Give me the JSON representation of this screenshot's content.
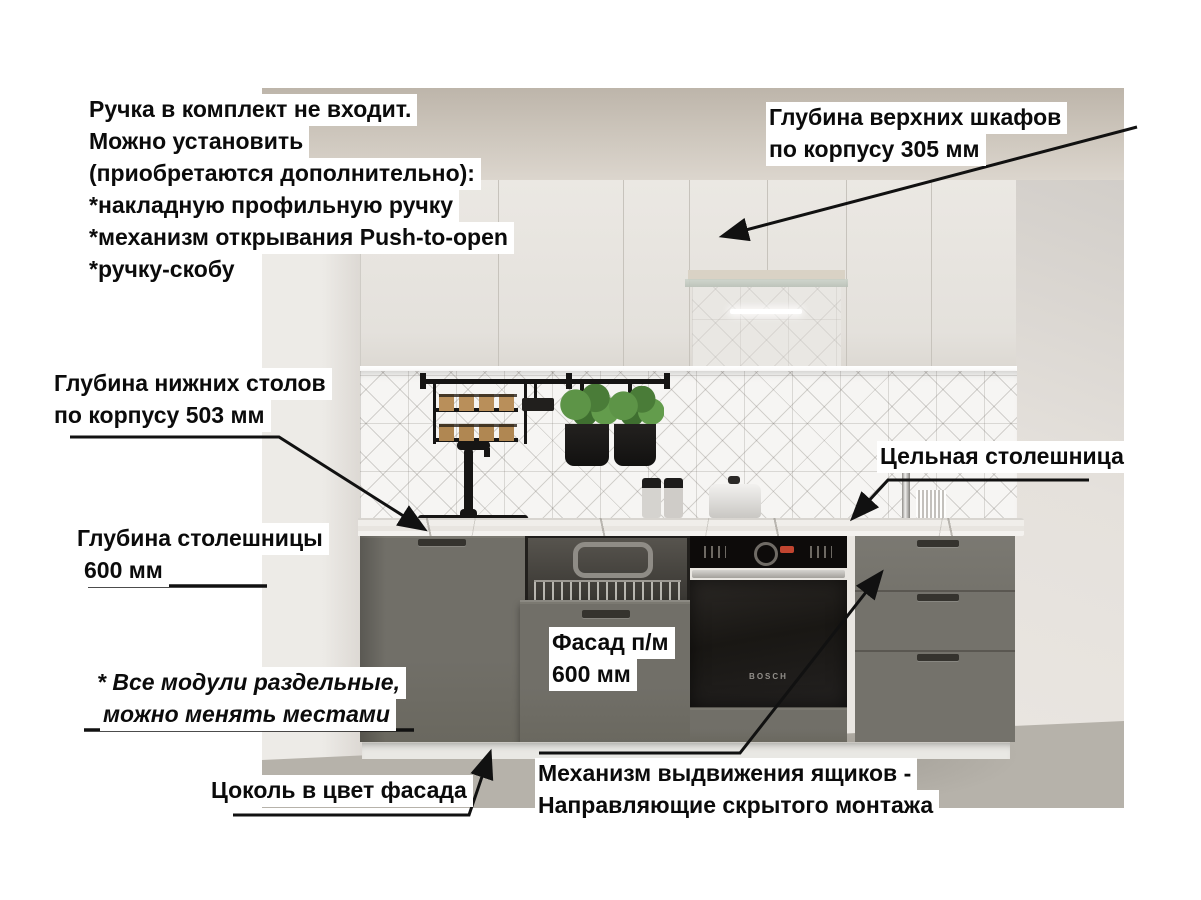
{
  "annotations": {
    "handle_note": {
      "lines": [
        "Ручка в комплект не входит.",
        "Можно установить",
        "(приобретаются дополнительно):",
        "*накладную профильную ручку",
        "*механизм открывания Push-to-open",
        "*ручку-скобу"
      ]
    },
    "upper_depth": {
      "lines": [
        "Глубина верхних шкафов",
        "по корпусу 305 мм"
      ]
    },
    "lower_depth": {
      "lines": [
        "Глубина нижних столов",
        "по корпусу 503 мм"
      ]
    },
    "countertop_depth": {
      "lines": [
        "Глубина столешницы",
        "600 мм"
      ]
    },
    "solid_countertop": {
      "text": "Цельная столешница"
    },
    "facade_size": {
      "lines": [
        "Фасад п/м",
        "600 мм"
      ]
    },
    "modules_note": {
      "lines": [
        "* Все модули раздельные,",
        "можно менять местами"
      ]
    },
    "plinth_note": {
      "text": "Цоколь в цвет фасада"
    },
    "drawer_mechanism": {
      "lines": [
        "Механизм выдвижения ящиков -",
        "Направляющие скрытого монтажа"
      ]
    }
  },
  "scene": {
    "oven_brand": "BOSCH",
    "colors": {
      "facade_lower": "#6f6d66",
      "facade_upper": "#e8e5e0",
      "countertop": "#edebe7",
      "backsplash": "#f6f5f3",
      "floor_concrete": "#b6b2aa",
      "ceiling": "#c7bfb4",
      "annotation_text": "#0b0b0b",
      "annotation_background": "#ffffff",
      "arrow": "#111111",
      "oven_black": "#1a1815",
      "oven_display_red": "#c14530"
    }
  }
}
